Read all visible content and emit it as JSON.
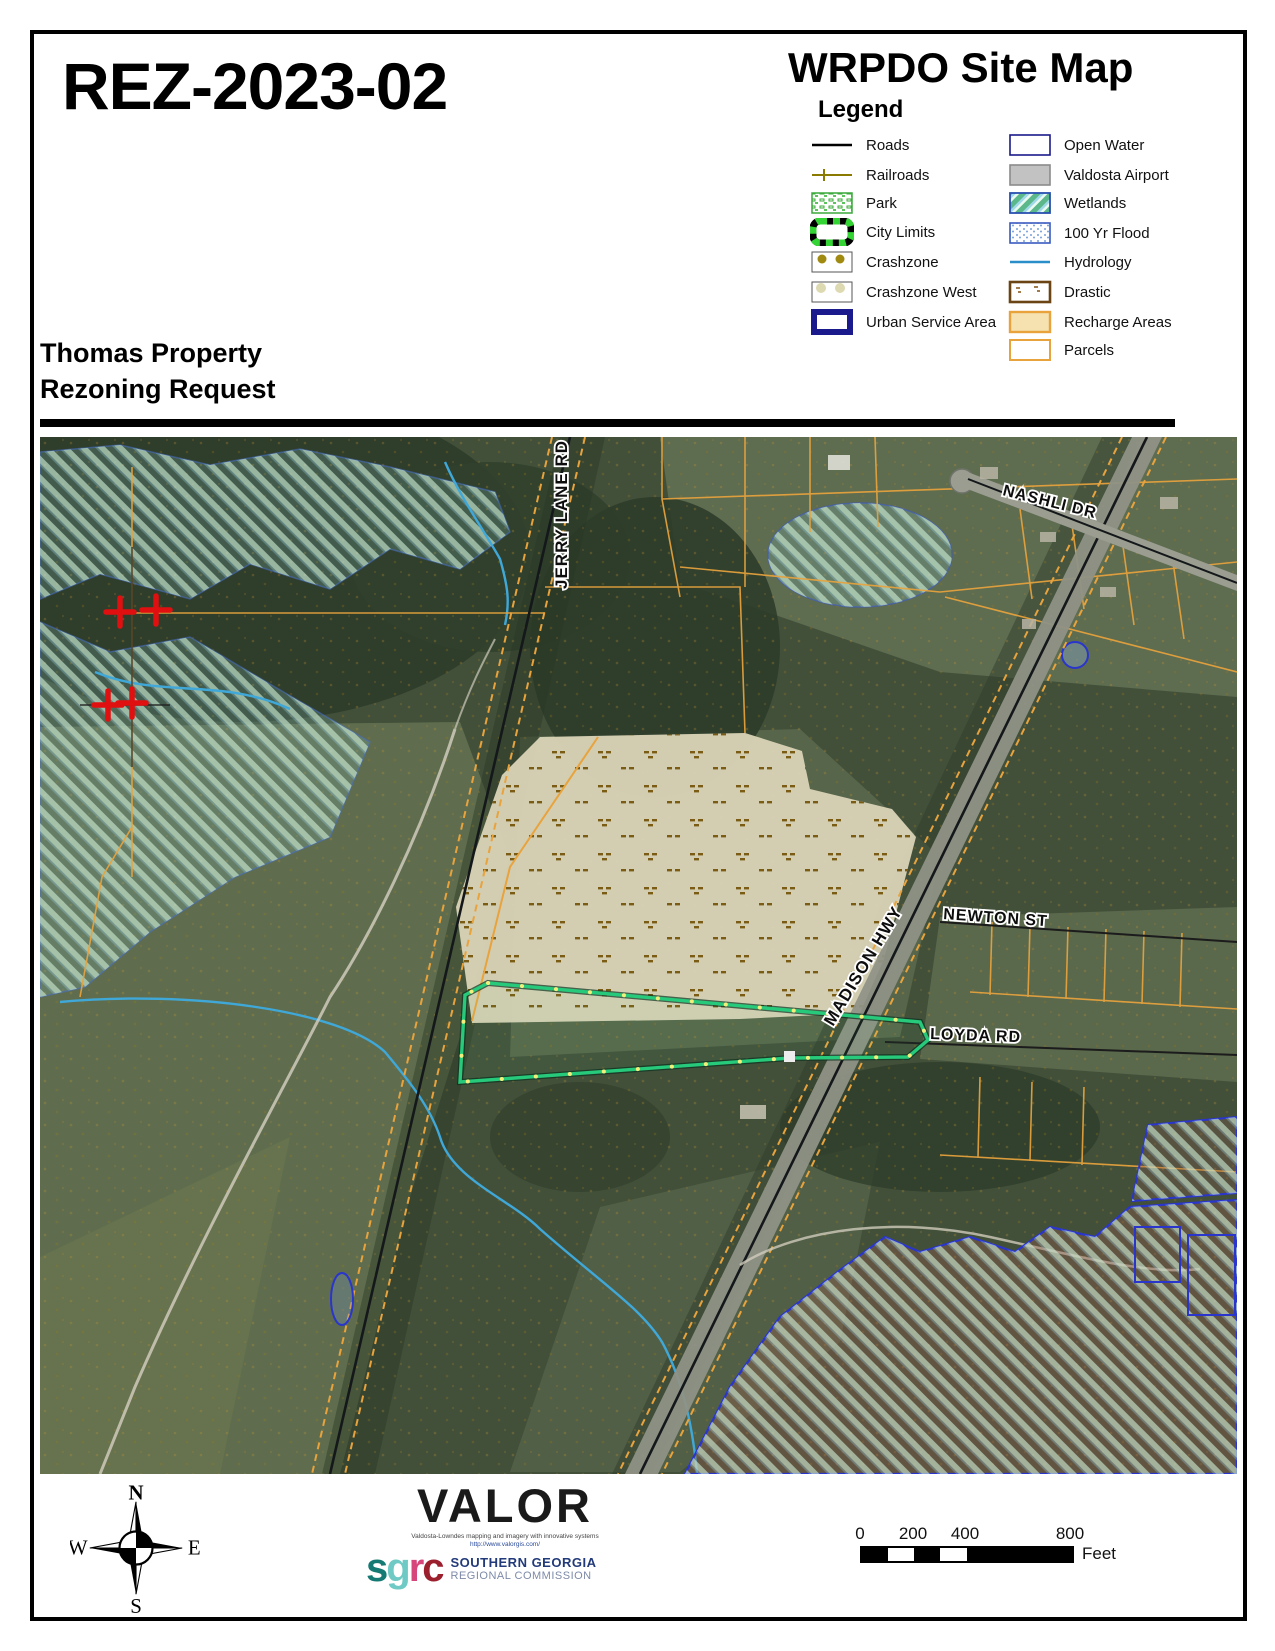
{
  "header": {
    "case_number": "REZ-2023-02",
    "map_title": "WRPDO Site Map",
    "subtitle_line1": "Thomas Property",
    "subtitle_line2": "Rezoning Request"
  },
  "legend": {
    "title": "Legend",
    "left_items": [
      {
        "label": "Roads",
        "symbol": "road-line"
      },
      {
        "label": "Railroads",
        "symbol": "railroad-line"
      },
      {
        "label": "Park",
        "symbol": "park-swatch"
      },
      {
        "label": "City Limits",
        "symbol": "city-limits-swatch"
      },
      {
        "label": "Crashzone",
        "symbol": "crashzone-swatch"
      },
      {
        "label": "Crashzone West",
        "symbol": "crashzone-west-swatch"
      },
      {
        "label": "Urban Service Area",
        "symbol": "urban-service-area-swatch"
      }
    ],
    "right_items": [
      {
        "label": "Open Water",
        "symbol": "open-water-swatch"
      },
      {
        "label": "Valdosta Airport",
        "symbol": "airport-swatch"
      },
      {
        "label": "Wetlands",
        "symbol": "wetlands-swatch"
      },
      {
        "label": "100 Yr Flood",
        "symbol": "flood-swatch"
      },
      {
        "label": "Hydrology",
        "symbol": "hydrology-line"
      },
      {
        "label": "Drastic",
        "symbol": "drastic-swatch"
      },
      {
        "label": "Recharge Areas",
        "symbol": "recharge-swatch"
      },
      {
        "label": "Parcels",
        "symbol": "parcels-swatch"
      }
    ]
  },
  "map": {
    "labels": {
      "jerry": "JERRY LANE RD",
      "nashli": "NASHLI DR",
      "newton": "NEWTON ST",
      "madison": "MADISON HWY",
      "loyda": "LOYDA RD"
    }
  },
  "footer": {
    "compass": {
      "n": "N",
      "e": "E",
      "s": "S",
      "w": "W"
    },
    "valor": {
      "name": "VALOR",
      "tagline1": "Valdosta-Lowndes mapping and imagery with innovative systems",
      "tagline2": "http://www.valorgis.com/"
    },
    "sgrc": {
      "letter_s": "s",
      "letter_g": "g",
      "letter_r": "r",
      "letter_c": "c",
      "line1": "SOUTHERN GEORGIA",
      "line2": "REGIONAL COMMISSION"
    },
    "scalebar": {
      "ticks": [
        "0",
        "200",
        "400",
        "800"
      ],
      "unit": "Feet"
    }
  },
  "colors": {
    "parcel_orange": "#e8a33d",
    "subject_parcel_green": "#27c97a",
    "subject_vertex_yellow": "#f2ef7d",
    "hydrology_blue": "#3fa8d8",
    "open_water_navy": "#2a35cc",
    "recharge_fill": "#f5e2b0",
    "drastic_brown": "#7a4a1a",
    "railroad_olive": "#8a7a00",
    "crash_marker_red": "#e01010"
  }
}
